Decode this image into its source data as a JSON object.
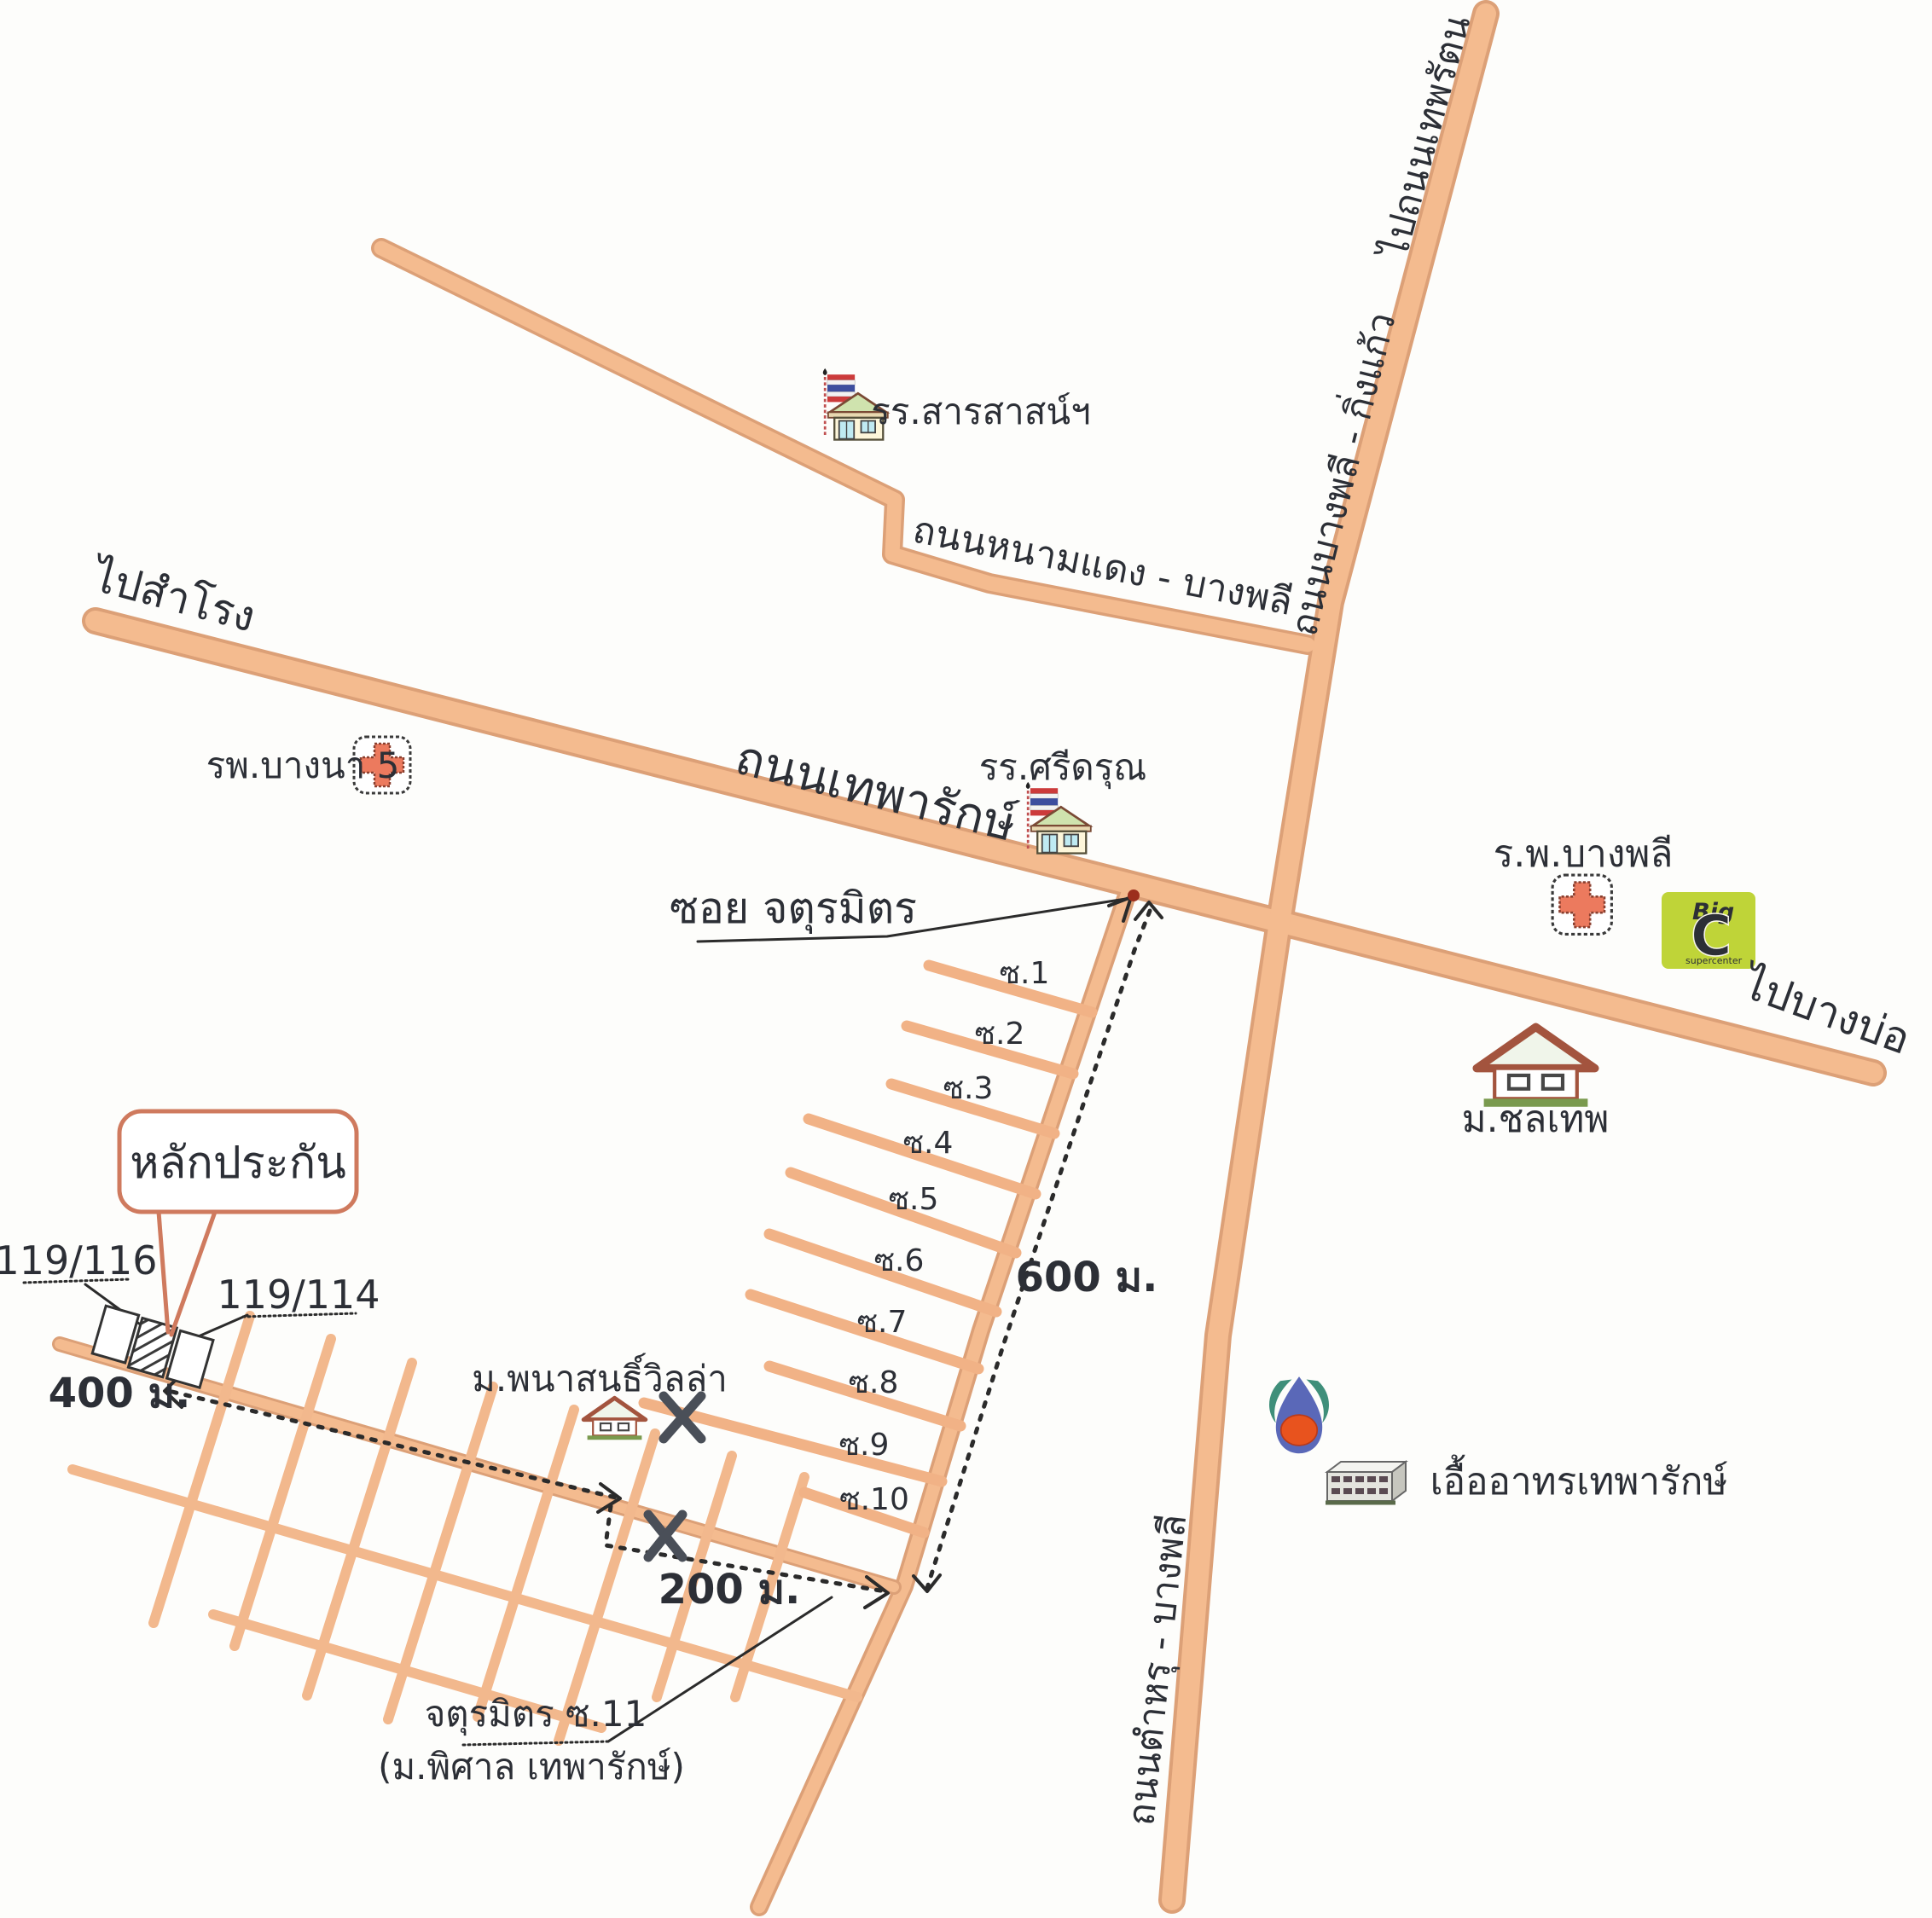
{
  "roads": {
    "theparak_label": "ถนนเทพารักษ์",
    "to_samrong_label": "ไปสำโรง",
    "to_bangbo_label": "ไปบางบ่อ",
    "namdaeng_label": "ถนนหนามแดง - บางพลี",
    "to_theparat_label": "ไปถนนเทพรัตน",
    "bangphli_kingkaew_label": "ถนนบางพลี - กิ่งแก้ว",
    "tamru_label": "ถนนตำหรุ - บางพลี",
    "soi_jaturamit_label": "ซอย จตุรมิตร",
    "soi11_label": "จตุรมิตร ซ.11",
    "soi11_sub_label": "(ม.พิศาล เทพารักษ์)"
  },
  "sois": [
    "ซ.1",
    "ซ.2",
    "ซ.3",
    "ซ.4",
    "ซ.5",
    "ซ.6",
    "ซ.7",
    "ซ.8",
    "ซ.9",
    "ซ.10"
  ],
  "places": {
    "school_sarasas": "รร.สารสาสน์ฯ",
    "school_sridarun": "รร.ศรีดรุณ",
    "hospital_bangna5": "รพ.บางนา 5",
    "hospital_bangphli": "ร.พ.บางพลี",
    "moo_ban_chonthep": "ม.ชลเทพ",
    "moo_ban_phanason": "ม.พนาสนธิ์วิลล่า",
    "uea_athon": "เอื้ออาทรเทพารักษ์",
    "bigc_big": "Big",
    "bigc_c": "C",
    "bigc_sub": "supercenter"
  },
  "callout": {
    "label": "หลักประกัน"
  },
  "plots": {
    "left": "119/116",
    "right": "119/114"
  },
  "distances": {
    "d400": "400 ม.",
    "d200": "200 ม.",
    "d600": "600 ม."
  },
  "colors": {
    "road_fill": "#f4bb8f",
    "road_edge": "#dca077",
    "ink": "#2c2f36",
    "callout_border": "#cf7a5e",
    "hospital_cross": "#ec7a5e",
    "bigc_green": "#bfd438",
    "bigc_orange": "#e2622a",
    "ptt_blue": "#5a68b8",
    "ptt_orange": "#e8531e",
    "ptt_green": "#3f8f7a",
    "roof_brown": "#a3543e",
    "base_green": "#7a9a4e",
    "flag_red": "#cc3b3b",
    "flag_blue": "#3d4e9e",
    "window_blue": "#bfeaf2"
  }
}
